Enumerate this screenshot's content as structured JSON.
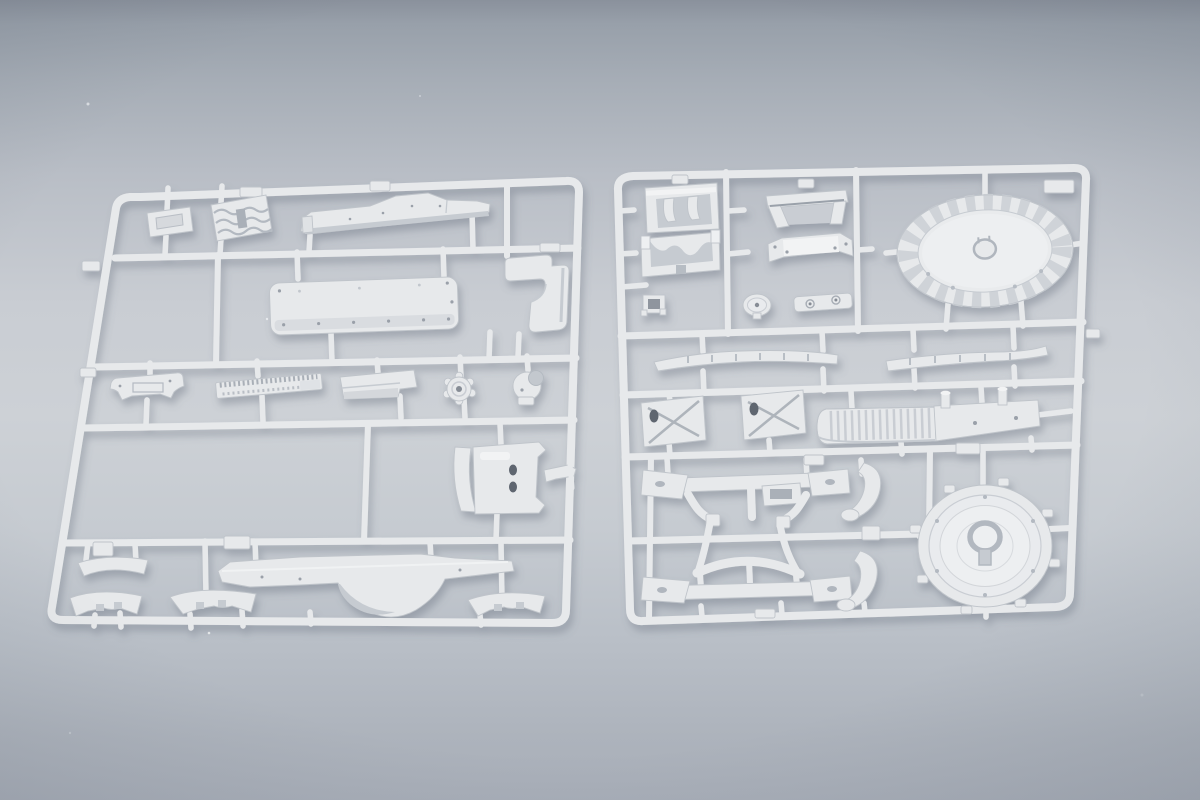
{
  "scene": {
    "kind": "photograph",
    "subject": "Two light-grey injection-moulded polystyrene model-kit sprues (parts frames) lying side by side on a neutral grey studio backdrop",
    "lighting": "soft diffuse top light with gentle vignette",
    "sprue_count": 2,
    "text_visible": "none"
  },
  "colors": {
    "bg_top": "#8a919c",
    "bg_upper": "#a6adb6",
    "bg_light": "#cdd1d6",
    "bg_lower": "#b9bfc7",
    "bg_bottom": "#a8aeb8",
    "plastic_base": "#e7e9eb",
    "plastic_light": "#f2f3f4",
    "plastic_mid": "#d9dcdf",
    "plastic_shadow": "#c6cbd1",
    "plastic_outline": "#bfc4ca",
    "recess_dark": "#9aa1aa",
    "hole_dark": "#5f6670",
    "cast_shadow": "#5a6472"
  },
  "left_sprue": {
    "name": "left parts frame",
    "description": "deck panels, fenders and hull fittings on a rectangular runner frame with four internal rails",
    "parts": [
      "hatch-plate",
      "corrugated-section",
      "tapered-deck-panel",
      "corner-bracket",
      "riveted-panel",
      "flared-mount",
      "toothed-strip",
      "angled-plate",
      "sprocket-hub",
      "crescent-hub",
      "holed-bracket",
      "bracket-arm",
      "fender-strip-upper",
      "fender-strip-left",
      "fender-strip-middle",
      "fender-strip-right",
      "v-shaped-fender"
    ]
  },
  "right_sprue": {
    "name": "right parts frame",
    "description": "toothed turret ring, round hatch, chassis frames, mounts and brackets on a rectangular runner frame",
    "parts": [
      "engine-yoke",
      "cradle-mount",
      "u-bracket",
      "tray-bracket",
      "clamp-block",
      "pulley-disc",
      "twin-hole-plate",
      "turret-ring",
      "leaf-blade-left",
      "leaf-blade-right",
      "x-brace-box-1",
      "x-brace-box-2",
      "ribbed-cylinder",
      "peg-plate",
      "chassis-frame-upper",
      "chassis-frame-lower",
      "s-arm-upper",
      "s-arm-lower",
      "round-hatch"
    ]
  }
}
